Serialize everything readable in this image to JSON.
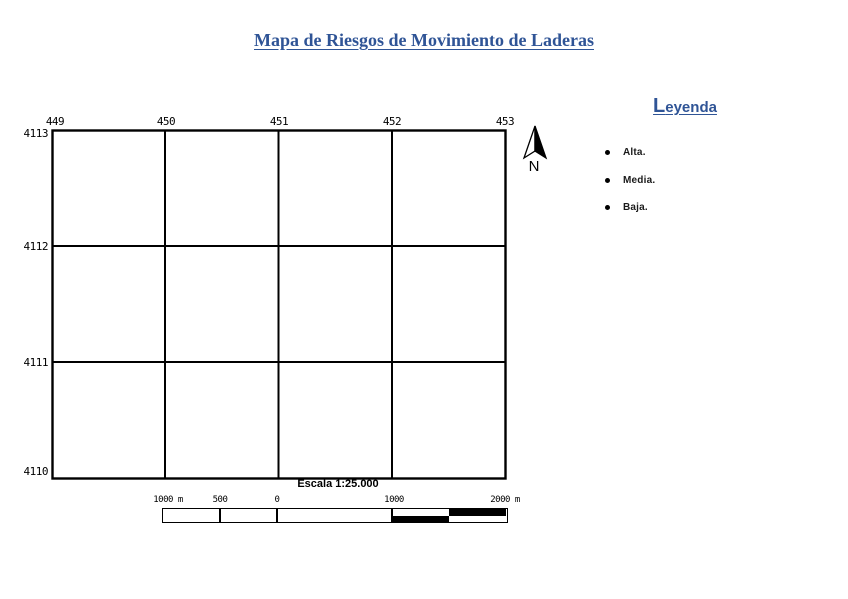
{
  "page": {
    "title": "Mapa de Riesgos de Movimiento de Laderas"
  },
  "colors": {
    "accent_blue": "#2F5496",
    "ink": "#000000"
  },
  "map": {
    "x_axis_labels": [
      "449",
      "450",
      "451",
      "452",
      "453"
    ],
    "y_axis_labels": [
      "4113",
      "4112",
      "4111",
      "4110"
    ],
    "north_label": "N",
    "scale_caption": "Escala 1:25.000",
    "scalebar_labels": [
      "1000 m",
      "500",
      "0",
      "1000",
      "2000 m"
    ]
  },
  "legend": {
    "title_initial": "L",
    "title_rest": "eyenda",
    "items": [
      {
        "label": "Alta."
      },
      {
        "label": "Media."
      },
      {
        "label": "Baja."
      }
    ]
  }
}
